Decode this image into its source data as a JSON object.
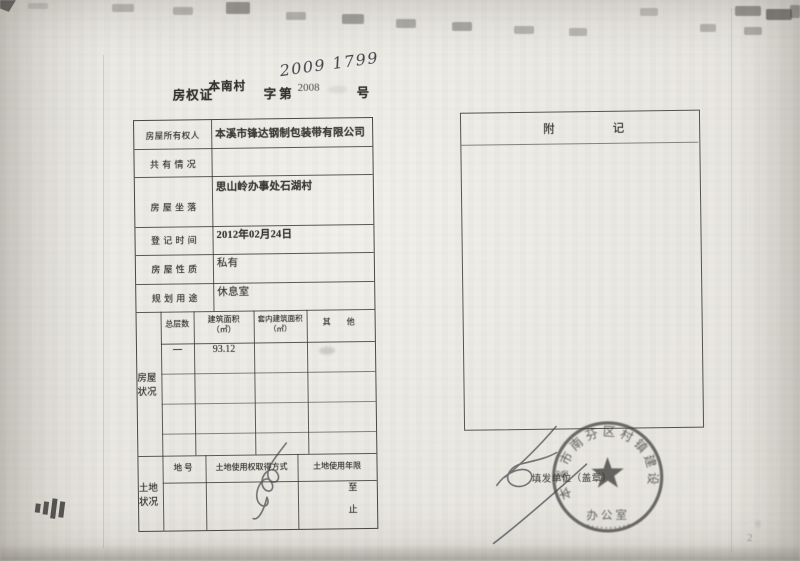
{
  "doc": {
    "kind": "property-ownership-certificate-scan",
    "title": {
      "prefix": "房权证",
      "region": "本南村",
      "zi_di": "字第",
      "printed_no": "2008",
      "handwritten_no": "2009 1799",
      "suffix": "号"
    },
    "page_no": "2"
  },
  "main_table": {
    "rows": [
      {
        "label": "房屋所有权人",
        "value": "本溪市锋达钢制包装带有限公司"
      },
      {
        "label": "共 有 情 况",
        "value": ""
      },
      {
        "label": "房 屋 坐 落",
        "value": "思山岭办事处石湖村"
      },
      {
        "label": "登 记 时 间",
        "value": "2012年02月24日"
      },
      {
        "label": "房 屋 性 质",
        "value": "私有"
      },
      {
        "label": "规 划 用 途",
        "value": "休息室"
      }
    ],
    "house_section": {
      "side_label": "房屋状况",
      "headers": [
        {
          "t": "总层数",
          "u": ""
        },
        {
          "t": "建筑面积",
          "u": "（㎡）"
        },
        {
          "t": "套内建筑面积",
          "u": "（㎡）"
        },
        {
          "t": "其　他",
          "u": ""
        }
      ],
      "data_row": {
        "total_floors": "一",
        "floor_area": "93.12",
        "inner_area": "",
        "other": ""
      }
    },
    "land_section": {
      "side_label": "土地状况",
      "headers": [
        "地号",
        "土地使用权取得方式",
        "土地使用年限"
      ],
      "term_from": "至",
      "term_to": "止"
    }
  },
  "remark_box": {
    "title": "附记"
  },
  "issuer": {
    "label": "填发单位（盖章）",
    "seal_ring_text": "本溪市南芬区村镇建设",
    "seal_office_text": "办公室"
  },
  "colors": {
    "paper": "#ebe9e3",
    "ink": "#32302c",
    "seal_ink": "#3b3a36"
  }
}
